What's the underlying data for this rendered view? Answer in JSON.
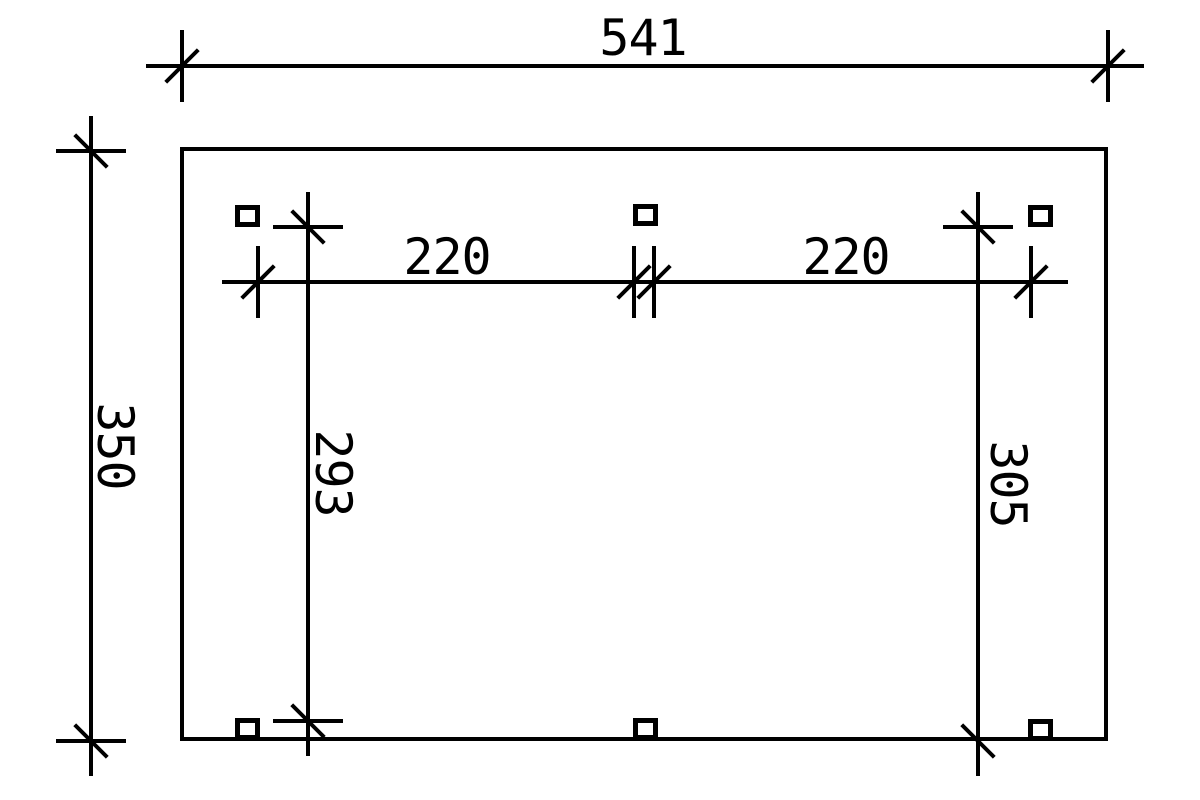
{
  "style": {
    "background": "#ffffff",
    "line_color": "#000000"
  },
  "plan": {
    "post_count": 6
  },
  "dimensions": {
    "total_width": "541",
    "total_depth": "350",
    "bay_left": "220",
    "bay_right": "220",
    "inner_depth_left": "293",
    "inner_depth_right": "305"
  }
}
